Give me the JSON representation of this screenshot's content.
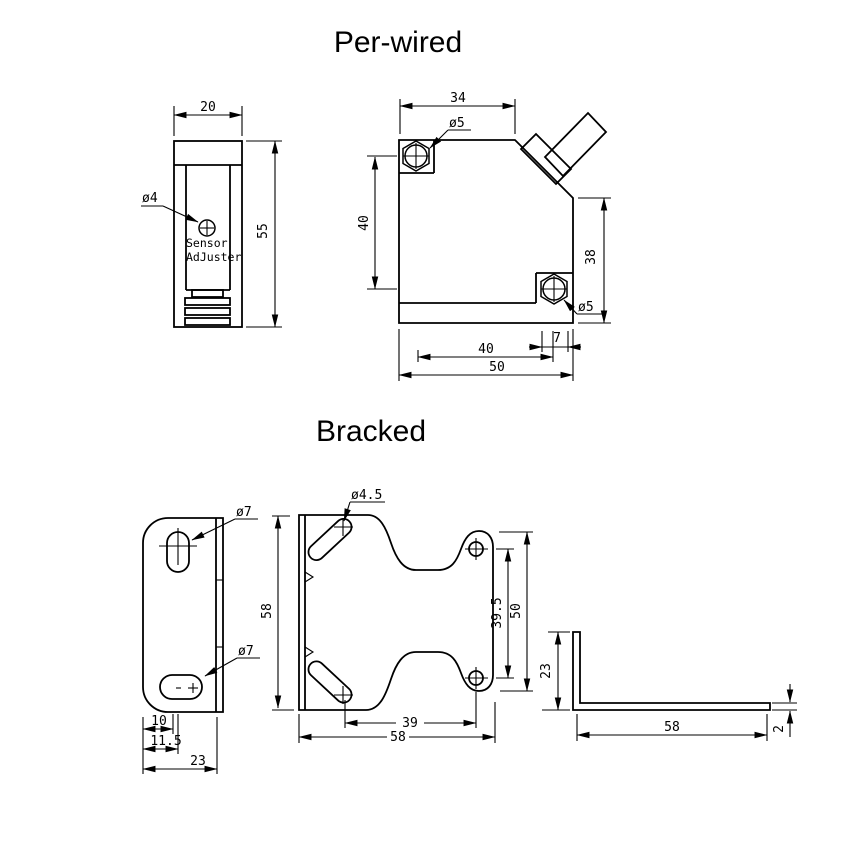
{
  "colors": {
    "line": "#000000",
    "background": "#ffffff"
  },
  "sections": {
    "per_wired": {
      "title": "Per-wired",
      "side_view": {
        "dim_width": "20",
        "dim_height": "55",
        "hole_label": "ø4",
        "adjuster_line1": "Sensor",
        "adjuster_line2": "AdJuster"
      },
      "front_view": {
        "dim_top_width": "34",
        "dim_left_height": "40",
        "dim_right_height": "38",
        "dim_bottom_offset": "7",
        "dim_bottom_width": "40",
        "dim_bottom_total": "50",
        "hole_top_label": "ø5",
        "hole_bottom_label": "ø5"
      }
    },
    "bracked": {
      "title": "Bracked",
      "side_view": {
        "hole_top_label": "ø7",
        "hole_bottom_label": "ø7",
        "dim_slot_offset": "10",
        "dim_slot_center": "11.5",
        "dim_depth": "23"
      },
      "front_view": {
        "slot_label": "ø4.5",
        "dim_height": "58",
        "dim_hole_spacing_v": "39.5",
        "dim_lobe_height": "50",
        "dim_hole_spacing_h": "39",
        "dim_width": "58"
      },
      "profile_view": {
        "dim_leg_height": "23",
        "dim_leg_length": "58",
        "dim_thickness": "2"
      }
    }
  }
}
